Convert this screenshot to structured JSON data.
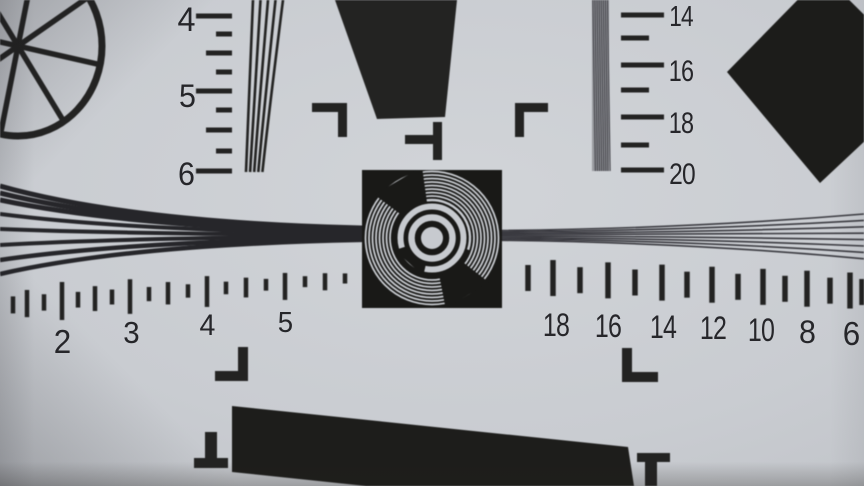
{
  "chart": {
    "kind": "camera-resolution-test-chart-photo",
    "center_marker": "concentric-ring-focus-target"
  },
  "scales": {
    "left_vertical": {
      "labels": [
        "4",
        "5",
        "6"
      ]
    },
    "right_vertical": {
      "labels": [
        "14",
        "16",
        "18",
        "20"
      ]
    },
    "bottom_left": {
      "labels": [
        "2",
        "3",
        "4",
        "5"
      ]
    },
    "bottom_right": {
      "labels": [
        "18",
        "16",
        "14",
        "12",
        "10",
        "8",
        "6"
      ]
    }
  },
  "colors": {
    "ink": "#232322",
    "paper": "#c9ccd1",
    "paper_edge": "#b2b5ba",
    "ring_light": "#c7cacf",
    "target_black": "#191917",
    "fine_line": "#3a3a40"
  },
  "shapes": {
    "wheel": "spoked-circle-wheel",
    "focus_target": "concentric-rings",
    "diamond": "rotated-square-marker",
    "top_bar": "slanted-black-bar",
    "bottom_bar": "slanted-black-bar",
    "wedge_lines": "converging-line-wedges",
    "corner_marks": "registration-brackets"
  }
}
